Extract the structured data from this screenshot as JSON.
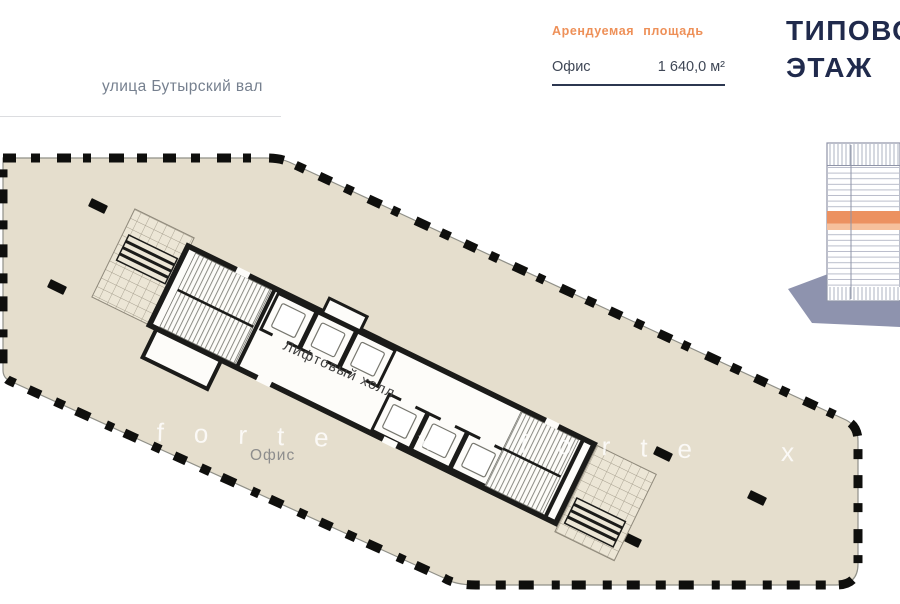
{
  "street": {
    "label": "улица Бутырский вал"
  },
  "legend": {
    "title": "Арендуемая площадь",
    "item_label": "Офис",
    "item_value": "1 640,0 м²"
  },
  "sheet_title": {
    "line1": "ТИПОВОЙ",
    "line2": "ЭТАЖ"
  },
  "plan": {
    "office_label": "Офис",
    "hall_label": "Лифтовый холл",
    "watermark": "x forte x forte x forte"
  },
  "colors": {
    "floor_fill": "#e5decd",
    "walls": "#1b1b19",
    "perimeter_columns": "#0f0f0d",
    "accent_orange": "#ee9058",
    "title_navy": "#202a4c",
    "legend_rule_navy": "#2c3750",
    "building_shadow": "#8e93ae",
    "building_band": "#ec9160",
    "street_text": "#76808f"
  }
}
